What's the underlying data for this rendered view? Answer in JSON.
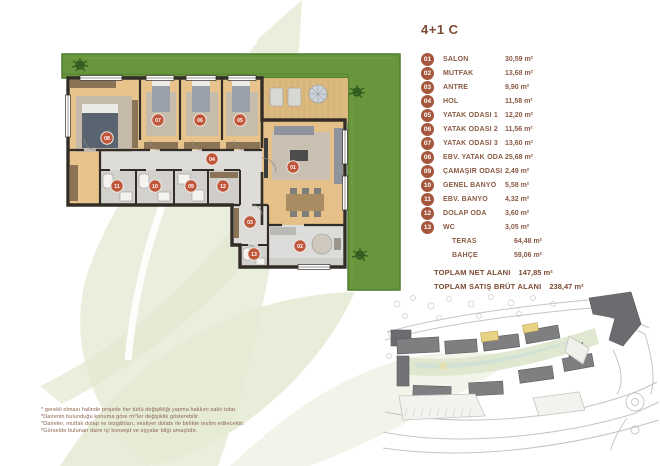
{
  "page": {
    "title": "4+1 C"
  },
  "colors": {
    "accent_brown": "#a4573d",
    "text_brown": "#8a5a44",
    "marker_orange": "#c0563a",
    "grass_green": "#69953d",
    "wood_floor": "#e8c38c",
    "watermark_green": "#eaeedd",
    "site_highlight_yellow": "#e8d184"
  },
  "legend": {
    "items": [
      {
        "num": "01",
        "label": "SALON",
        "value": "30,59 m²"
      },
      {
        "num": "02",
        "label": "MUTFAK",
        "value": "13,68 m²"
      },
      {
        "num": "03",
        "label": "ANTRE",
        "value": "9,90 m²"
      },
      {
        "num": "04",
        "label": "HOL",
        "value": "11,58 m²"
      },
      {
        "num": "05",
        "label": "YATAK ODASI 1",
        "value": "12,20 m²"
      },
      {
        "num": "06",
        "label": "YATAK ODASI 2",
        "value": "11,56 m²"
      },
      {
        "num": "07",
        "label": "YATAK ODASI 3",
        "value": "13,60 m²"
      },
      {
        "num": "08",
        "label": "EBV. YATAK ODA",
        "value": "25,68 m²"
      },
      {
        "num": "09",
        "label": "ÇAMAŞIR ODASI",
        "value": "2,49 m²"
      },
      {
        "num": "10",
        "label": "GENEL BANYO",
        "value": "5,58 m²"
      },
      {
        "num": "11",
        "label": "EBV. BANYO",
        "value": "4,32 m²"
      },
      {
        "num": "12",
        "label": "DOLAP ODA",
        "value": "3,60 m²"
      },
      {
        "num": "13",
        "label": "WC",
        "value": "3,05 m²"
      }
    ],
    "extras": [
      {
        "label": "TERAS",
        "value": "64,48 m²"
      },
      {
        "label": "BAHÇE",
        "value": "59,06 m²"
      }
    ],
    "totals": [
      {
        "label": "TOPLAM NET ALANI",
        "value": "147,85 m²"
      },
      {
        "label": "TOPLAM SATIŞ BRÜT ALANI",
        "value": "238,47 m²"
      }
    ]
  },
  "floor_plan": {
    "markers": [
      "01",
      "02",
      "03",
      "04",
      "05",
      "06",
      "07",
      "08",
      "09",
      "10",
      "11",
      "12",
      "13"
    ]
  },
  "footnotes": [
    "*          gerekli olması halinde projede her türlü değişikliği yapma hakkını saklı tutar.",
    "*Dairenin bulunduğu konuma göre m²'ler değişiklik gösterebilir.",
    "*Daireler, mutfak dolap ve tezgâhları, vestiyer dolabı ile birlikte teslim edilecektir.",
    "*Görselde bulunan daire içi konsept ve eşyalar bilgi amaçlıdır."
  ]
}
